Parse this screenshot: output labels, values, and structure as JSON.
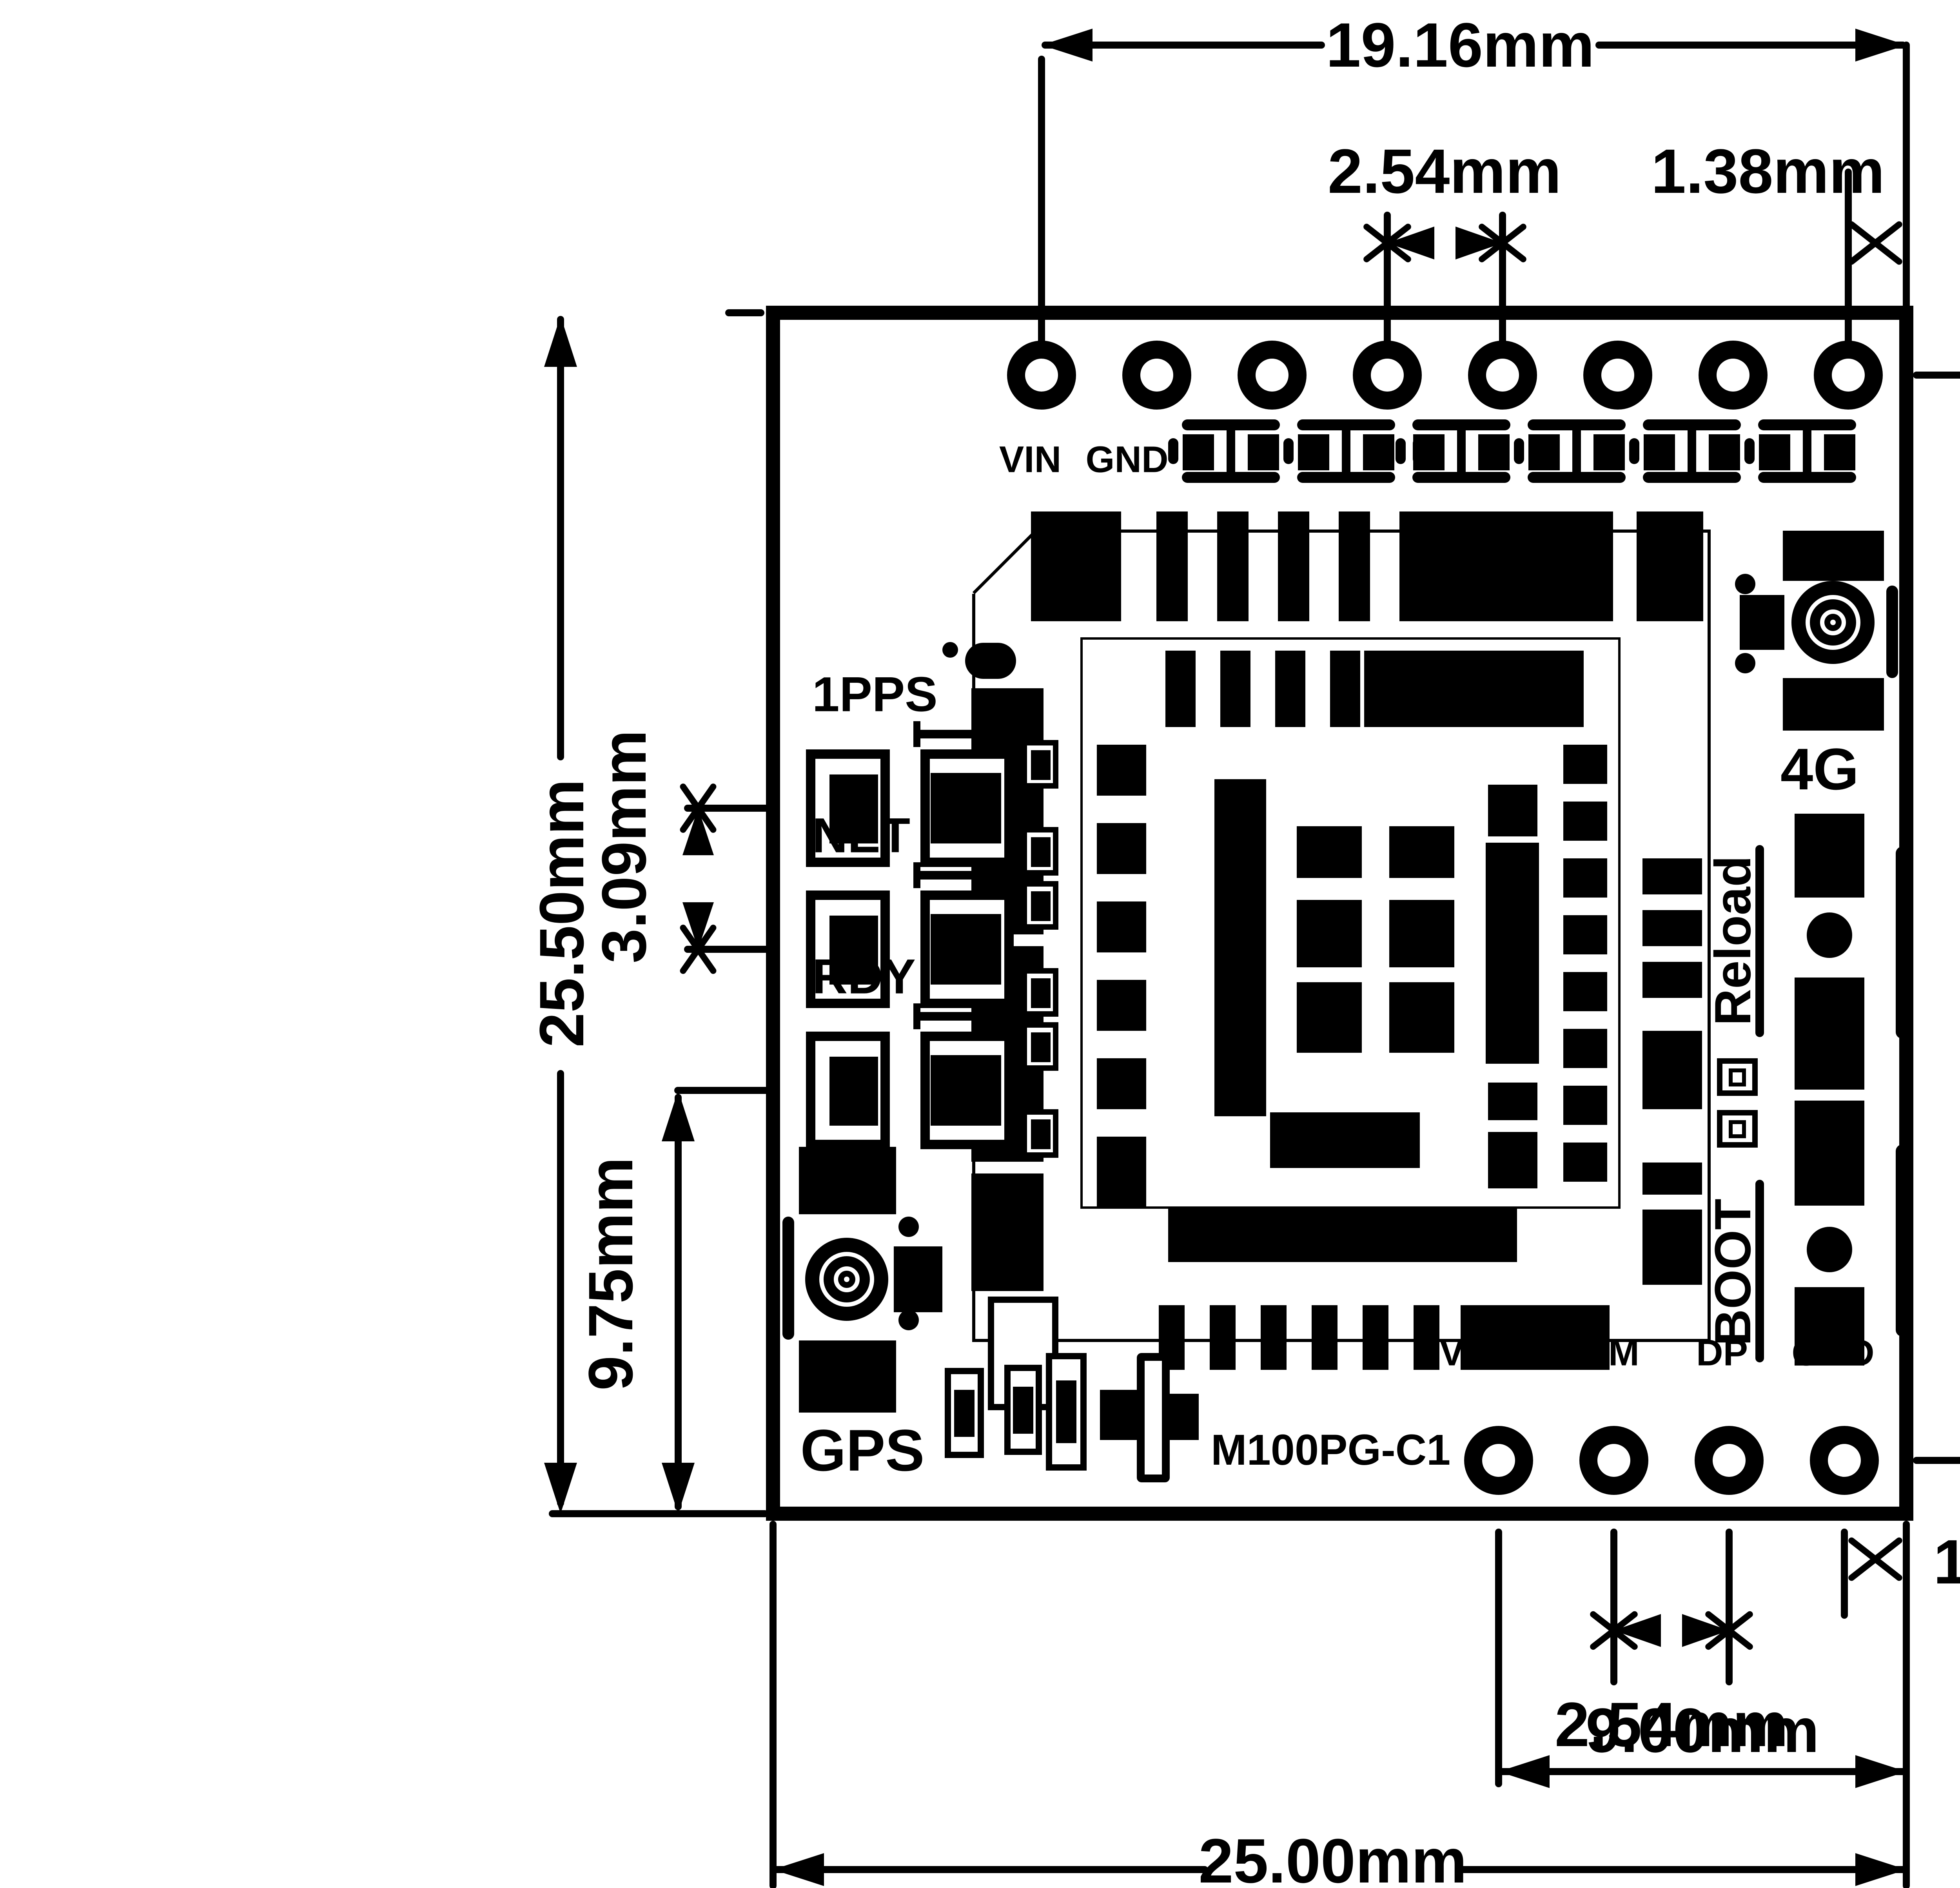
{
  "title": "M100PG-C1 module dimensional drawing",
  "module": {
    "name": "M100PG-C1"
  },
  "colors": {
    "ink": "#000000",
    "paper": "#ffffff"
  },
  "dimensions": {
    "top_width": "19.16mm",
    "pin_pitch_top": "2.54mm",
    "edge_offset_top": "1.38mm",
    "board_height": "25.50mm",
    "led_pitch": "3.09mm",
    "rdy_to_bottom": "9.75mm",
    "pad_row_span": "22.86mm",
    "pin_pitch_bottom": "2.54mm",
    "edge_offset_bottom": "1.38mm",
    "vbus_to_edge": "9.00mm",
    "board_width": "25.00mm"
  },
  "labels": {
    "vin": "VIN",
    "gnd_top": "GND",
    "pps": "1PPS",
    "net": "NET",
    "rdy": "RDY",
    "gps": "GPS",
    "g4": "4G",
    "reload": "Reload",
    "boot": "BOOT",
    "vbus": "VBUS",
    "dm": "DM",
    "dp": "DP",
    "gnd_bottom": "GND",
    "module": "M100PG-C1"
  }
}
